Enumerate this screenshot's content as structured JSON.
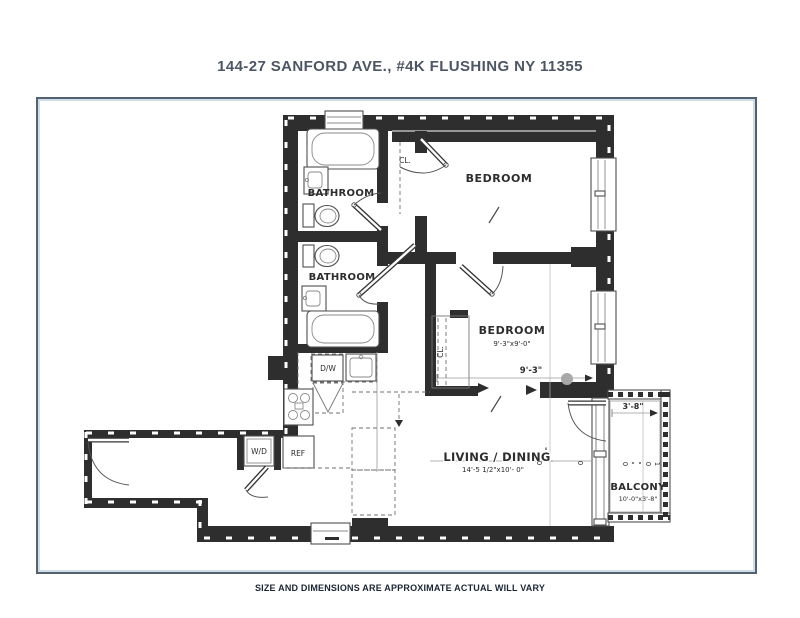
{
  "title": "144-27 SANFORD AVE., #4K FLUSHING NY 11355",
  "disclaimer": "SIZE AND DIMENSIONS ARE APPROXIMATE ACTUAL WILL VARY",
  "colors": {
    "title_text": "#4c5665",
    "disclaimer_text": "#1b2634",
    "frame_border": "#53626e",
    "frame_inner": "#cddee8",
    "wall": "#2e2e2e",
    "marker_dot": "#a8a8a8"
  },
  "rooms": {
    "bathroom_top": "BATHROOM",
    "bathroom_middle": "BATHROOM",
    "bedroom_top": "BEDROOM",
    "bedroom_middle": "BEDROOM",
    "bedroom_middle_dims": "9'-3\"x9'-0\"",
    "living_dining": "LIVING / DINING",
    "living_dining_dims": "14'-5 1/2\"x10'- 0\"",
    "balcony": "BALCONY",
    "balcony_dims": "10'-0\"x3'-8\""
  },
  "labels": {
    "closet_top": "CL.",
    "closet_bedroom": "CL.",
    "dishwasher": "D/W",
    "refrigerator": "REF",
    "washer_dryer": "W/D"
  },
  "dimensions": {
    "bedroom_width": "9'-3\"",
    "balcony_depth": "3'-8\""
  },
  "marks": {
    "living_mark": "°",
    "rotated": [
      "0",
      "0",
      "0",
      "0",
      "1"
    ]
  }
}
